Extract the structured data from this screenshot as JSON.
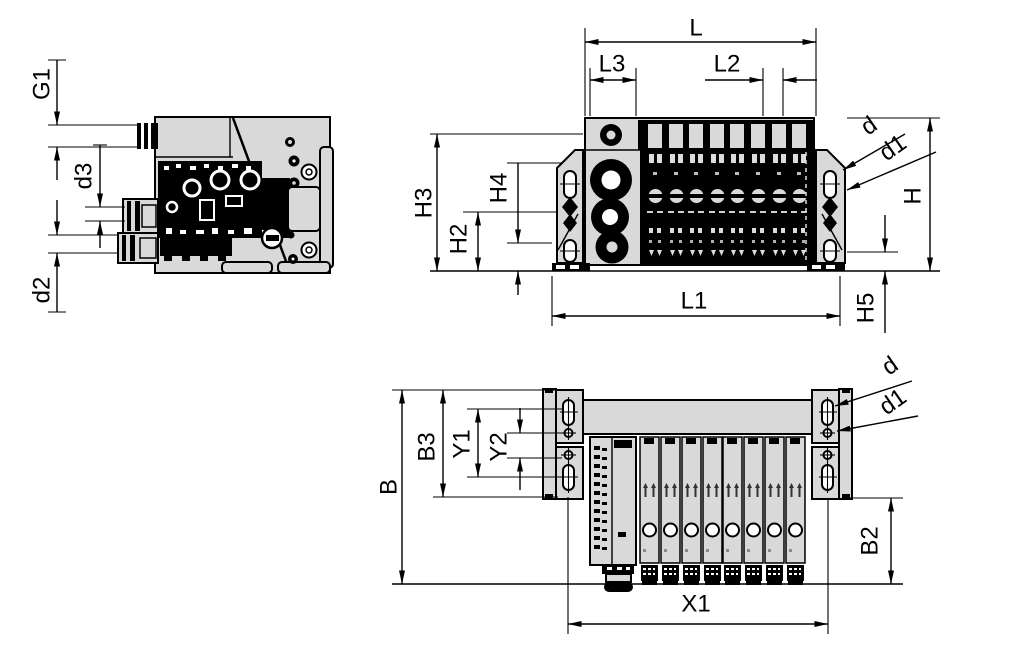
{
  "drawing": {
    "kind": "valve-terminal dimensional drawing, three views",
    "valve_slice_count": 8,
    "colors": {
      "line": "#000000",
      "body_fill": "#d9d9d9",
      "detail_fill": "#dcdcdc",
      "background": "#ffffff"
    }
  },
  "labels": {
    "side": {
      "g1": "G1",
      "d3": "d3",
      "d2": "d2"
    },
    "front": {
      "l": "L",
      "l3": "L3",
      "l2": "L2",
      "h3": "H3",
      "h4": "H4",
      "h2": "H2",
      "l1": "L1",
      "h5": "H5",
      "h": "H",
      "d": "d",
      "d1": "d1"
    },
    "top": {
      "b": "B",
      "b3": "B3",
      "y1": "Y1",
      "y2": "Y2",
      "x1": "X1",
      "b2": "B2",
      "d": "d",
      "d1": "d1"
    }
  }
}
